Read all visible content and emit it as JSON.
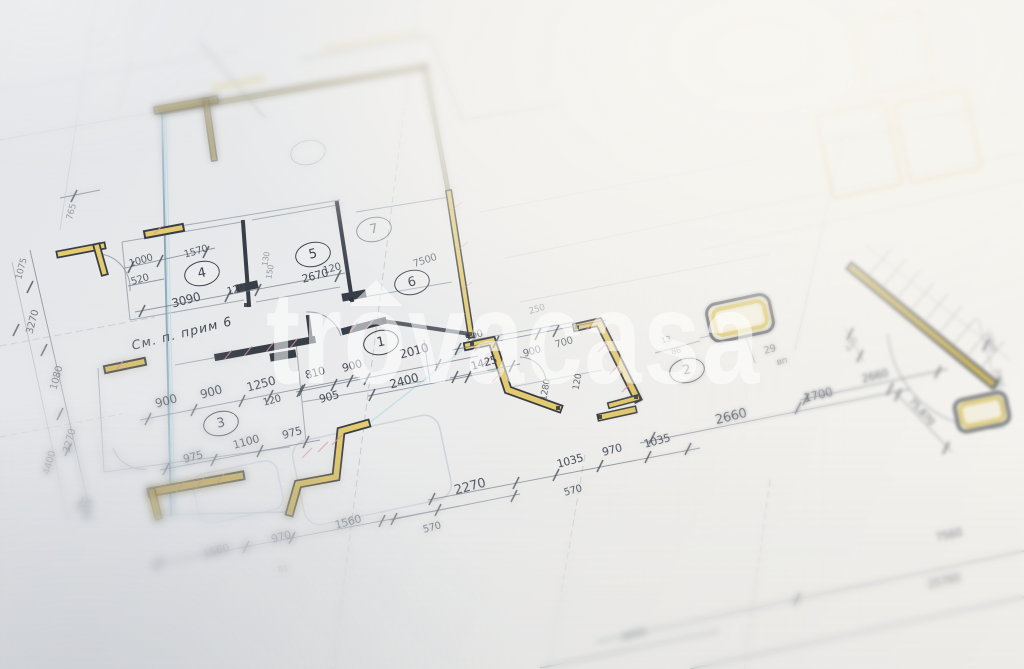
{
  "watermark": {
    "pre": "tr",
    "o": "o",
    "post": "vacasa"
  },
  "palette": {
    "wall_yellow": "#e4cb6e",
    "hatch_red": "#d9959b",
    "ink": "#383e48",
    "pipe_cyan": "#8fd8ec",
    "dim_text": "#474e58"
  },
  "plan": {
    "note": "См. п. прим 6",
    "rooms": [
      {
        "n": "1",
        "x": 381,
        "y": 342,
        "o": 1
      },
      {
        "n": "2",
        "x": 687,
        "y": 370,
        "o": 0.85
      },
      {
        "n": "3",
        "x": 221,
        "y": 423,
        "o": 1
      },
      {
        "n": "4",
        "x": 202,
        "y": 273,
        "o": 1
      },
      {
        "n": "5",
        "x": 313,
        "y": 254,
        "o": 1
      },
      {
        "n": "6",
        "x": 412,
        "y": 282,
        "o": 1
      },
      {
        "n": "7",
        "x": 374,
        "y": 229,
        "o": 0.55
      },
      {
        "n": "",
        "x": 308,
        "y": 152,
        "o": 0.3
      }
    ],
    "labels": [
      {
        "t": "765",
        "x": 72,
        "y": 212,
        "r": -75,
        "s": 9,
        "o": 0.5
      },
      {
        "t": "1075",
        "x": 22,
        "y": 269,
        "r": -75,
        "s": 9,
        "o": 0.6
      },
      {
        "t": "3270",
        "x": 33,
        "y": 322,
        "r": -75,
        "s": 10,
        "o": 0.75
      },
      {
        "t": "1080",
        "x": 57,
        "y": 378,
        "r": -75,
        "s": 10,
        "o": 0.75
      },
      {
        "t": "3270",
        "x": 70,
        "y": 441,
        "r": -75,
        "s": 10,
        "o": 0.75
      },
      {
        "t": "4400",
        "x": 50,
        "y": 463,
        "r": -75,
        "s": 10,
        "o": 0.7
      },
      {
        "t": "1075",
        "x": 88,
        "y": 510,
        "r": -75,
        "s": 9,
        "o": 0.7
      },
      {
        "t": "1000",
        "x": 141,
        "y": 261,
        "r": -16,
        "s": 10,
        "o": 0.85
      },
      {
        "t": "1570",
        "x": 196,
        "y": 252,
        "r": -16,
        "s": 10,
        "o": 0.85
      },
      {
        "t": "520",
        "x": 140,
        "y": 280,
        "r": -16,
        "s": 10,
        "o": 0.85
      },
      {
        "t": "3090",
        "x": 186,
        "y": 300,
        "r": -15,
        "s": 12,
        "o": 1
      },
      {
        "t": "120",
        "x": 236,
        "y": 290,
        "r": -15,
        "s": 10,
        "o": 1
      },
      {
        "t": "2670",
        "x": 315,
        "y": 276,
        "r": -15,
        "s": 11,
        "o": 1
      },
      {
        "t": "120",
        "x": 332,
        "y": 269,
        "r": -15,
        "s": 10,
        "o": 0.9
      },
      {
        "t": "7500",
        "x": 425,
        "y": 261,
        "r": -18,
        "s": 10,
        "o": 0.8
      },
      {
        "t": "130",
        "x": 266,
        "y": 259,
        "r": -80,
        "s": 8,
        "o": 0.5
      },
      {
        "t": "150",
        "x": 270,
        "y": 272,
        "r": -80,
        "s": 8,
        "o": 0.5
      },
      {
        "t": "См. п. прим 6",
        "x": 182,
        "y": 333,
        "r": -14,
        "s": 12.5,
        "o": 1,
        "c": "note"
      },
      {
        "t": "2010",
        "x": 414,
        "y": 351,
        "r": -15,
        "s": 12,
        "o": 1
      },
      {
        "t": "900",
        "x": 352,
        "y": 366,
        "r": -15,
        "s": 11,
        "o": 1
      },
      {
        "t": "810",
        "x": 315,
        "y": 373,
        "r": -15,
        "s": 11,
        "o": 1
      },
      {
        "t": "1250",
        "x": 261,
        "y": 384,
        "r": -15,
        "s": 12,
        "o": 1
      },
      {
        "t": "120",
        "x": 272,
        "y": 401,
        "r": -15,
        "s": 10,
        "o": 1
      },
      {
        "t": "905",
        "x": 329,
        "y": 397,
        "r": -15,
        "s": 11,
        "o": 1
      },
      {
        "t": "900",
        "x": 211,
        "y": 392,
        "r": -15,
        "s": 12,
        "o": 1
      },
      {
        "t": "900",
        "x": 166,
        "y": 401,
        "r": -15,
        "s": 12,
        "o": 1
      },
      {
        "t": "2400",
        "x": 404,
        "y": 381,
        "r": -15,
        "s": 12,
        "o": 1
      },
      {
        "t": "975",
        "x": 292,
        "y": 433,
        "r": -15,
        "s": 11,
        "o": 1
      },
      {
        "t": "1100",
        "x": 246,
        "y": 442,
        "r": -15,
        "s": 11,
        "o": 1
      },
      {
        "t": "975",
        "x": 193,
        "y": 457,
        "r": -15,
        "s": 11,
        "o": 1
      },
      {
        "t": "900",
        "x": 474,
        "y": 336,
        "r": -16,
        "s": 10,
        "o": 0.7
      },
      {
        "t": "700",
        "x": 564,
        "y": 343,
        "r": -16,
        "s": 10,
        "o": 0.75
      },
      {
        "t": "900",
        "x": 532,
        "y": 352,
        "r": -16,
        "s": 10,
        "o": 0.75
      },
      {
        "t": "1425",
        "x": 484,
        "y": 363,
        "r": -16,
        "s": 11,
        "o": 1
      },
      {
        "t": "1280",
        "x": 546,
        "y": 390,
        "r": -80,
        "s": 9,
        "o": 0.8
      },
      {
        "t": "120",
        "x": 578,
        "y": 382,
        "r": -80,
        "s": 9,
        "o": 0.8
      },
      {
        "t": "250",
        "x": 537,
        "y": 310,
        "r": -16,
        "s": 9,
        "o": 0.4
      },
      {
        "t": "13",
        "x": 666,
        "y": 340,
        "r": -15,
        "s": 8,
        "o": 0.6
      },
      {
        "t": "86",
        "x": 676,
        "y": 351,
        "r": -15,
        "s": 8,
        "o": 0.6
      },
      {
        "t": "29",
        "x": 770,
        "y": 350,
        "r": -15,
        "s": 10,
        "o": 0.8
      },
      {
        "t": "вп",
        "x": 782,
        "y": 362,
        "r": -15,
        "s": 9,
        "o": 0.7
      },
      {
        "t": "1700",
        "x": 818,
        "y": 395,
        "r": -14,
        "s": 12,
        "o": 1
      },
      {
        "t": "2660",
        "x": 731,
        "y": 417,
        "r": -14,
        "s": 13,
        "o": 1
      },
      {
        "t": "2660",
        "x": 875,
        "y": 376,
        "r": -14,
        "s": 11,
        "o": 0.8
      },
      {
        "t": "420",
        "x": 852,
        "y": 345,
        "r": -55,
        "s": 9,
        "o": 0.45
      },
      {
        "t": "75,870",
        "x": 921,
        "y": 412,
        "r": 48,
        "s": 10,
        "o": 0.8
      },
      {
        "t": "1000",
        "x": 991,
        "y": 342,
        "r": 78,
        "s": 8,
        "o": 0.5
      },
      {
        "t": "2020",
        "x": 999,
        "y": 378,
        "r": 78,
        "s": 8,
        "o": 0.5
      },
      {
        "t": "1035",
        "x": 570,
        "y": 461,
        "r": -15,
        "s": 11,
        "o": 1
      },
      {
        "t": "970",
        "x": 612,
        "y": 450,
        "r": -15,
        "s": 11,
        "o": 1
      },
      {
        "t": "1035",
        "x": 657,
        "y": 441,
        "r": -15,
        "s": 11,
        "o": 1
      },
      {
        "t": "570",
        "x": 573,
        "y": 491,
        "r": -15,
        "s": 10,
        "o": 1
      },
      {
        "t": "2270",
        "x": 470,
        "y": 487,
        "r": -15,
        "s": 13,
        "o": 1
      },
      {
        "t": "570",
        "x": 432,
        "y": 528,
        "r": -15,
        "s": 10,
        "o": 0.9
      },
      {
        "t": "1560",
        "x": 348,
        "y": 522,
        "r": -15,
        "s": 11,
        "o": 0.8
      },
      {
        "t": "970",
        "x": 281,
        "y": 537,
        "r": -15,
        "s": 11,
        "o": 0.8
      },
      {
        "t": "1560",
        "x": 216,
        "y": 551,
        "r": -15,
        "s": 11,
        "o": 0.7
      },
      {
        "t": "83",
        "x": 283,
        "y": 569,
        "r": -15,
        "s": 8,
        "o": 0.4
      },
      {
        "t": "7560",
        "x": 949,
        "y": 535,
        "r": -13,
        "s": 11,
        "o": 0.75
      },
      {
        "t": "25760",
        "x": 944,
        "y": 581,
        "r": -13,
        "s": 11,
        "o": 0.7
      },
      {
        "t": "6450",
        "x": 634,
        "y": 635,
        "r": -15,
        "s": 10,
        "o": 0.6
      }
    ]
  }
}
